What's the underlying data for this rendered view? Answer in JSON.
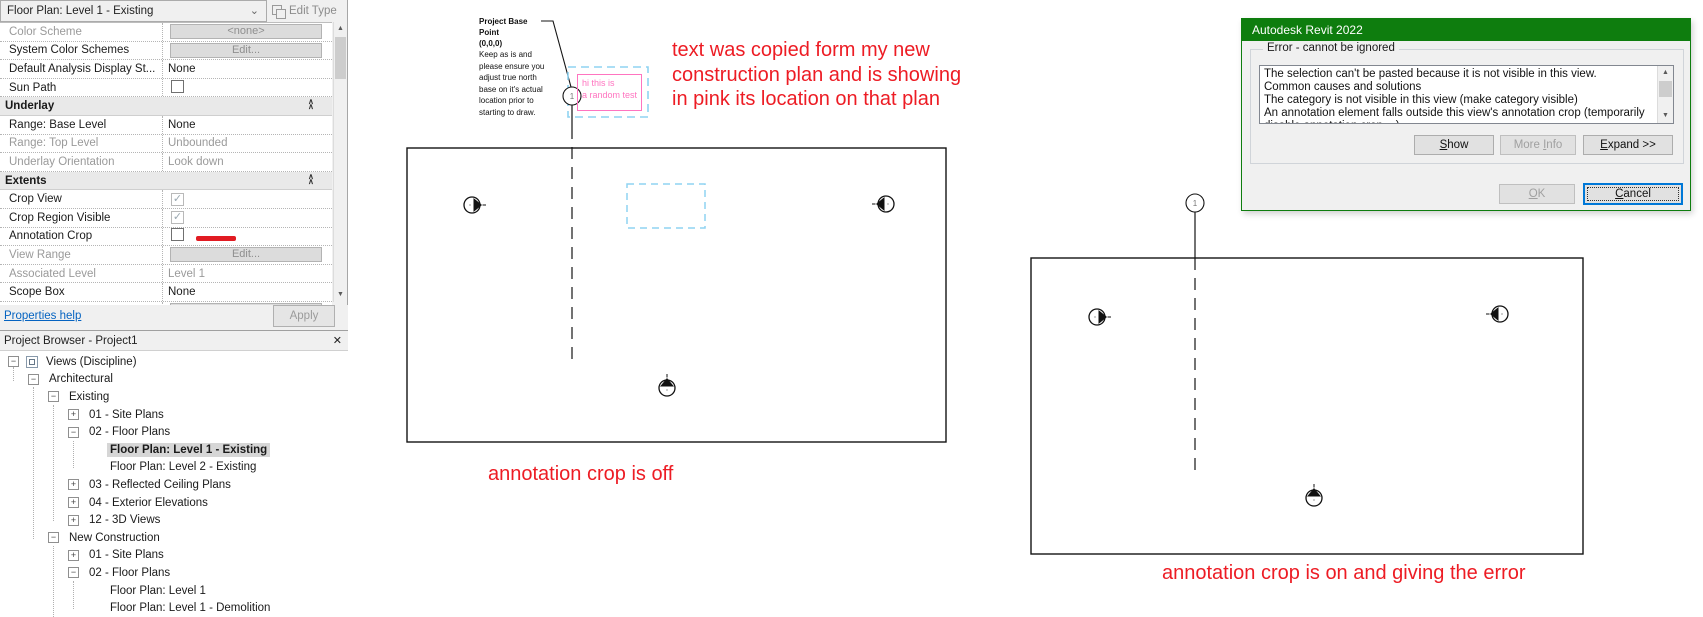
{
  "colors": {
    "dialog_title_green": "#0e7d0e",
    "annotation_red": "#ed1c24",
    "pasted_pink": "#ff74c0",
    "selection_cyan": "#8fd3f2",
    "link_blue": "#0563c1",
    "focus_blue": "#0078d7",
    "red_marker": "#e11b22"
  },
  "icons": {
    "chevron_down": "⌄",
    "close": "✕",
    "scroll_up": "▲",
    "scroll_down": "▼",
    "expand_plus": "+",
    "collapse_minus": "−"
  },
  "properties": {
    "type_selector": "Floor Plan: Level 1 - Existing",
    "edit_type_label": "Edit Type",
    "help_label": "Properties help",
    "apply_label": "Apply",
    "rows": [
      {
        "label": "Color Scheme",
        "kind": "button",
        "value": "<none>",
        "disabled": true
      },
      {
        "label": "System Color Schemes",
        "kind": "button",
        "value": "Edit...",
        "disabled": false
      },
      {
        "label": "Default Analysis Display St...",
        "kind": "text",
        "value": "None"
      },
      {
        "label": "Sun Path",
        "kind": "checkbox",
        "checked": false
      },
      {
        "label": "Underlay",
        "kind": "header"
      },
      {
        "label": "Range: Base Level",
        "kind": "text",
        "value": "None"
      },
      {
        "label": "Range: Top Level",
        "kind": "text",
        "value": "Unbounded",
        "disabled": true,
        "value_disabled": true
      },
      {
        "label": "Underlay Orientation",
        "kind": "text",
        "value": "Look down",
        "disabled": true,
        "value_disabled": true
      },
      {
        "label": "Extents",
        "kind": "header"
      },
      {
        "label": "Crop View",
        "kind": "checkbox",
        "checked": true,
        "check_disabled": true
      },
      {
        "label": "Crop Region Visible",
        "kind": "checkbox",
        "checked": true,
        "check_disabled": true
      },
      {
        "label": "Annotation Crop",
        "kind": "checkbox",
        "checked": false,
        "red_mark": true
      },
      {
        "label": "View Range",
        "kind": "button",
        "value": "Edit...",
        "disabled": true
      },
      {
        "label": "Associated Level",
        "kind": "text",
        "value": "Level 1",
        "disabled": true,
        "value_disabled": true
      },
      {
        "label": "Scope Box",
        "kind": "text",
        "value": "None"
      },
      {
        "label": "Depth Clipping",
        "kind": "button",
        "value": "None",
        "disabled": true
      }
    ]
  },
  "browser": {
    "title": "Project Browser - Project1",
    "tree": [
      {
        "label": "Views (Discipline)",
        "level": 0,
        "exp": "minus",
        "icon": true
      },
      {
        "label": "Architectural",
        "level": 1,
        "exp": "minus"
      },
      {
        "label": "Existing",
        "level": 2,
        "exp": "minus"
      },
      {
        "label": "01 - Site Plans",
        "level": 3,
        "exp": "plus"
      },
      {
        "label": "02 - Floor Plans",
        "level": 3,
        "exp": "minus"
      },
      {
        "label": "Floor Plan: Level 1 - Existing",
        "level": 4,
        "exp": "none",
        "selected": true
      },
      {
        "label": "Floor Plan: Level 2 - Existing",
        "level": 4,
        "exp": "none"
      },
      {
        "label": "03 - Reflected Ceiling Plans",
        "level": 3,
        "exp": "plus"
      },
      {
        "label": "04 - Exterior Elevations",
        "level": 3,
        "exp": "plus"
      },
      {
        "label": "12 - 3D Views",
        "level": 3,
        "exp": "plus"
      },
      {
        "label": "New Construction",
        "level": 2,
        "exp": "minus"
      },
      {
        "label": "01 - Site Plans",
        "level": 3,
        "exp": "plus"
      },
      {
        "label": "02 - Floor Plans",
        "level": 3,
        "exp": "minus"
      },
      {
        "label": "Floor Plan: Level 1",
        "level": 4,
        "exp": "none"
      },
      {
        "label": "Floor Plan: Level 1 - Demolition",
        "level": 4,
        "exp": "none"
      }
    ]
  },
  "canvas": {
    "pbp_note": {
      "title": "Project Base Point",
      "coords": "(0,0,0)",
      "lines": [
        "Keep as is and",
        "please ensure you",
        "adjust true north",
        "base on it's actual",
        "location prior to",
        "starting to draw."
      ]
    },
    "pink_note_lines": [
      "hi this is",
      "a random test"
    ],
    "red_note_lines": [
      "text was copied form my new",
      "construction plan and is showing",
      "in pink its location on that plan"
    ],
    "caption_left": "annotation crop is off",
    "caption_right": "annotation crop is on and giving the error",
    "grid_bubble_label": "1"
  },
  "dialog": {
    "title": "Autodesk Revit 2022",
    "group_label": "Error - cannot be ignored",
    "message_lines": [
      "The selection can't be pasted because it is not visible in this view.",
      "Common causes and solutions",
      "The category is not visible in this view (make category visible)",
      "An annotation element falls outside this view's annotation crop (temporarily",
      "disable annotation crop ...)"
    ],
    "buttons": {
      "show": {
        "label": "Show",
        "mnemonic": 0
      },
      "more_info": {
        "label": "More Info",
        "mnemonic": 5
      },
      "expand": {
        "label": "Expand >>",
        "mnemonic": 0
      },
      "ok": {
        "label": "OK",
        "mnemonic": 0
      },
      "cancel": {
        "label": "Cancel",
        "mnemonic": 0
      }
    }
  }
}
